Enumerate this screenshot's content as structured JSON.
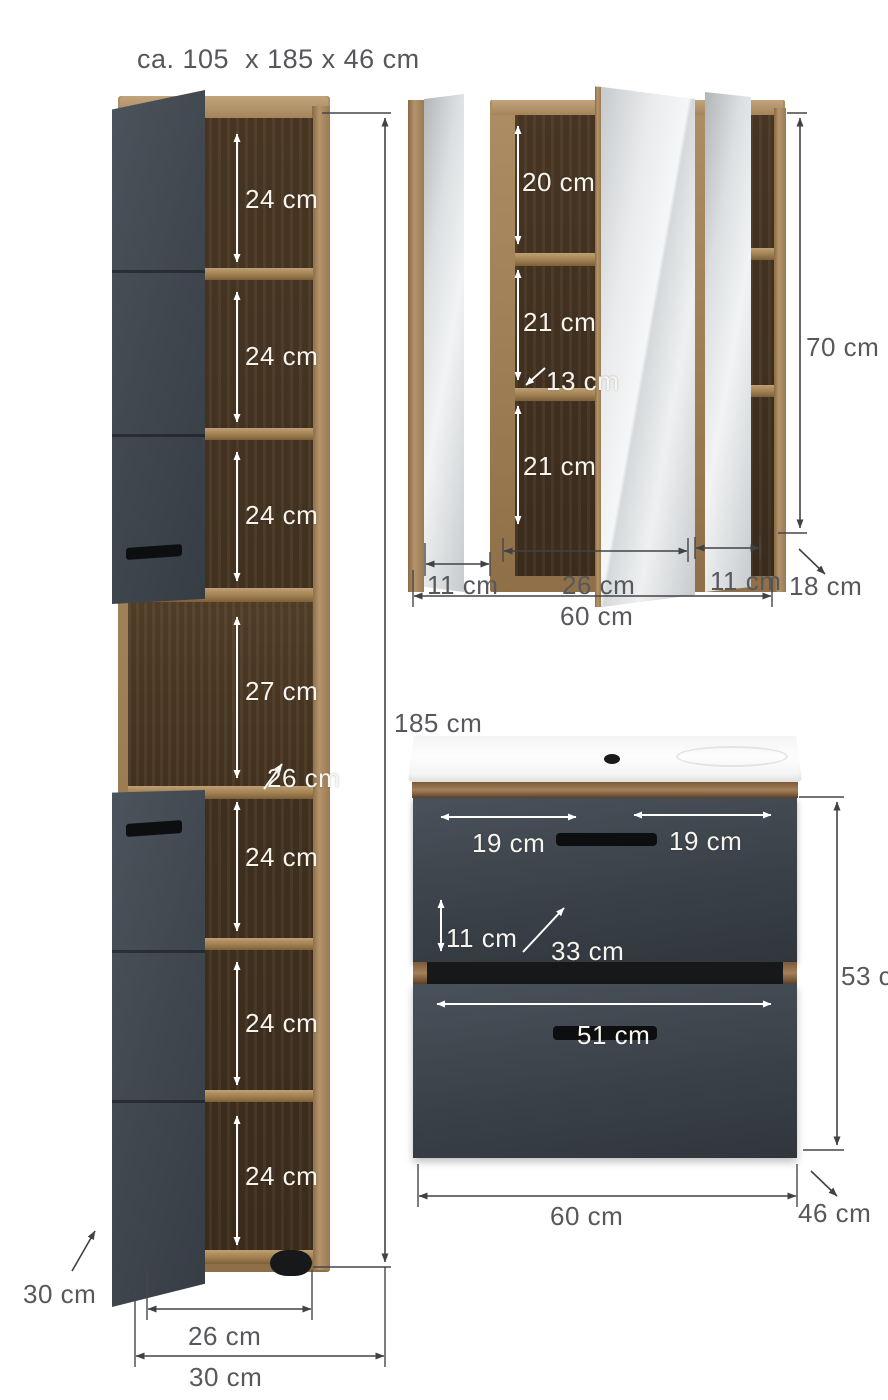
{
  "title": "ca. 105  x 185 x 46 cm",
  "tall_cabinet": {
    "height_label": "185 cm",
    "compartments": [
      "24 cm",
      "24 cm",
      "24 cm",
      "27 cm",
      "24 cm",
      "24 cm",
      "24 cm"
    ],
    "shelf_depth_label": "26 cm",
    "inner_width_label": "26 cm",
    "outer_width_label": "30 cm",
    "depth_label": "30 cm"
  },
  "mirror_cabinet": {
    "compartments": [
      "20 cm",
      "21 cm",
      "21 cm"
    ],
    "shelf_label": "13 cm",
    "height_label": "70 cm",
    "left_door_label": "11 cm",
    "center_width_label": "26 cm",
    "right_door_label": "11 cm",
    "width_label": "60 cm",
    "depth_label": "18 cm"
  },
  "vanity": {
    "drawer_left_label": "19 cm",
    "drawer_right_label": "19 cm",
    "front_height_label": "11 cm",
    "inner_depth_label": "33 cm",
    "lower_drawer_label": "51 cm",
    "height_label": "53 cm",
    "width_label": "60 cm",
    "depth_label": "46 cm"
  },
  "colors": {
    "front_dark": "#3e454c",
    "wood_light": "#a98a5f",
    "wood_interior": "#42311e",
    "mirror": "#dfe2e4",
    "dimension_line_dark": "#404246",
    "dimension_line_white": "#ffffff",
    "label_gray": "#56585c",
    "background": "#ffffff"
  }
}
